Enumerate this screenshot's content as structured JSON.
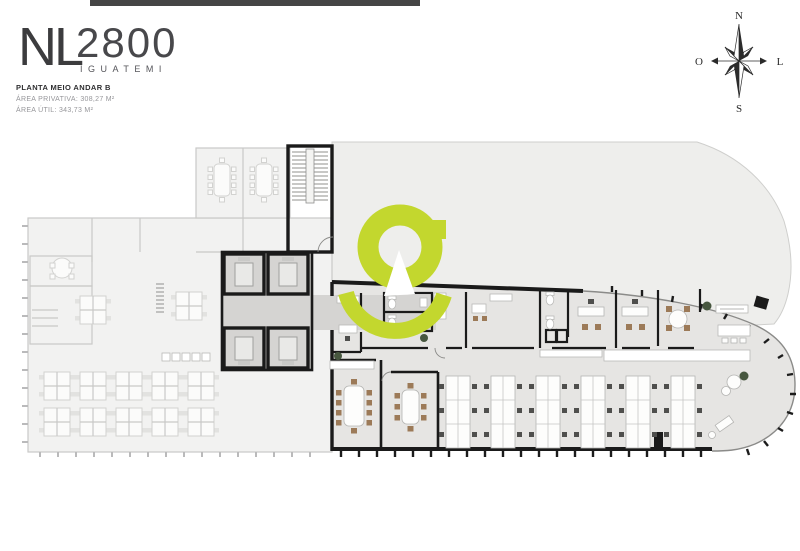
{
  "brand": {
    "monogram": "NL",
    "number": "2800",
    "name": "IGUATEMI"
  },
  "plan_info": {
    "title": "PLANTA MEIO ANDAR B",
    "area_private": "ÁREA PRIVATIVA: 308,27 M²",
    "area_useful": "ÁREA ÚTIL: 343,73 M²"
  },
  "compass": {
    "n": "N",
    "s": "S",
    "o": "O",
    "l": "L"
  },
  "colors": {
    "accent_green": "#c3d72e",
    "wall_black": "#1a1a1a",
    "floor_active": "#e6e5e3",
    "floor_faded": "#f2f2f1",
    "corridor_gray": "#d5d4d2"
  }
}
